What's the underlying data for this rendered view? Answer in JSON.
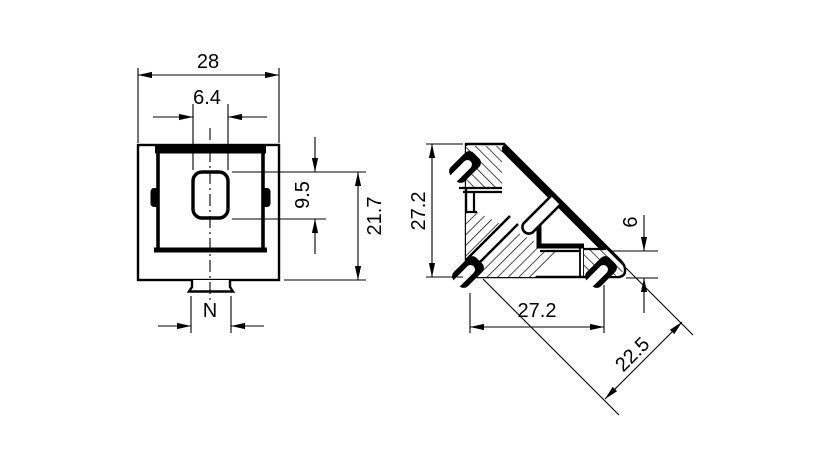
{
  "colors": {
    "background": "#ffffff",
    "ink": "#000000"
  },
  "front_view": {
    "dim_width": "28",
    "dim_slot_width": "6.4",
    "dim_slot_height": "9.5",
    "dim_slot_top_to_base": "21.7",
    "dim_tab_width": "N"
  },
  "side_view": {
    "dim_height": "27.2",
    "dim_depth": "27.2",
    "dim_foot_height": "6",
    "dim_diagonal_span": "22.5"
  }
}
